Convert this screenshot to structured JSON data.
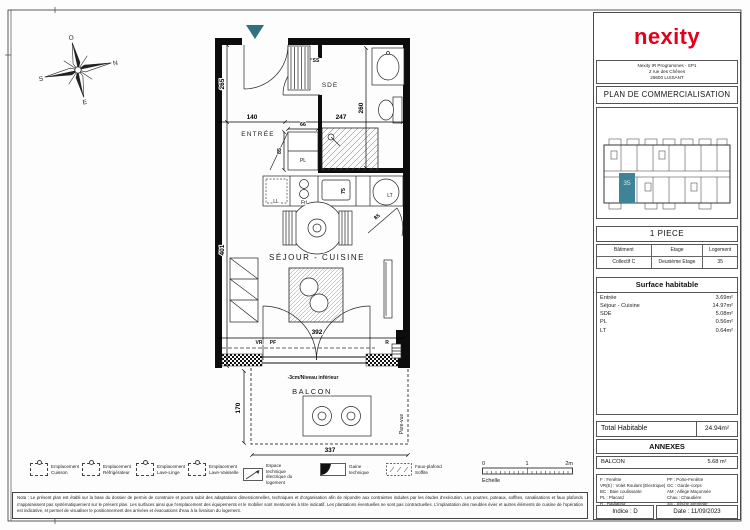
{
  "accent": {
    "teal": "#2d7183",
    "red": "#e2001a"
  },
  "brand": {
    "logo": "nexity"
  },
  "titleblock": {
    "address": [
      "Nexity IR Programmes - SP1",
      "2 rue des Chênes",
      "28600 LUISANT"
    ],
    "doc_title": "PLAN DE COMMERCIALISATION",
    "keyplan_unit": "35",
    "piece": "1 PIECE",
    "unit_headers": [
      "Bâtiment",
      "Etage",
      "Logement"
    ],
    "unit_values": [
      "Collectif C",
      "Deuxième Etage",
      "35"
    ],
    "surface_title": "Surface habitable",
    "surface_rows": [
      {
        "label": "Entrée",
        "value": "3.69m²"
      },
      {
        "label": "Séjour - Cuisine",
        "value": "14.97m²"
      },
      {
        "label": "SDE",
        "value": "5.08m²"
      },
      {
        "label": "PL",
        "value": "0.56m²"
      },
      {
        "label": "LT",
        "value": "0.64m²"
      }
    ],
    "total_label": "Total Habitable",
    "total_value": "24.94m²",
    "annexes_title": "ANNEXES",
    "annexe_label": "BALCON",
    "annexe_value": "5.68 m²",
    "abbr_left": [
      "F : Fenêtre",
      "VR(E) : Volet Roulant (Electrique)",
      "BC : Baie coulissante",
      "PL : Placard",
      "R : Radiateur"
    ],
    "abbr_right": [
      "PF : Porte-Fenêtre",
      "GC : Garde-corps",
      "AM : Allège Maçonnée",
      "Chau : Chaudière",
      "SS : Sèche Serviette"
    ],
    "indice": "Indice : D",
    "date": "Date : 11/09/2023"
  },
  "plan": {
    "rooms": {
      "entree": "ENTRÉE",
      "sde": "SDE",
      "sejour": "SÉJOUR - CUISINE",
      "balcon": "BALCON"
    },
    "labels": {
      "ss": "SS",
      "pl": "PL",
      "ll": "LL",
      "fri": "Fri",
      "lt": "LT",
      "vr": "VR",
      "pf": "PF",
      "r": "R",
      "level": "-3cm/Niveau inférieur",
      "pare_vue": "Pare-vue"
    },
    "dims": {
      "entree_h": "265",
      "top_left": "140",
      "top_right": "247",
      "sde_h": "260",
      "pl_w": "66",
      "pl_h": "85",
      "sink": "75",
      "door": "85",
      "sejour_h": "401",
      "sejour_w": "392",
      "balcon_h": "170",
      "balcon_w": "337"
    },
    "compass": {
      "n": "N",
      "s": "S",
      "e": "E",
      "o": "O"
    }
  },
  "legend": {
    "items": [
      "Emplacement Cuisson",
      "Emplacement Réfrigérateur",
      "Emplacement Lave-Linge",
      "Emplacement Lave-Vaisselle",
      "Espace technique électrique du logement",
      "Gaine technique",
      "Faux-plafond Soffite"
    ],
    "scale": {
      "t0": "0",
      "t1": "1",
      "t2": "2m",
      "label": "Echelle"
    }
  },
  "note": "Nota : Le présent plan est établi sur la base du dossier de permis de construire et pourra subir des adaptations dimensionnelles, techniques et d'organisation afin de répondre aux contraintes induites par les études d'exécution. Les poutres, poteaux, soffites, canalisations et faux plafonds n'apparaissent pas systématiquement sur le présent plan. Les surfaces ainsi que l'emplacement des équipements et le mobilier sont mentionnés à titre indicatif. Les plantations éventuelles ne sont pas contractuelles. L'implantation des meubles évier et autres éléments de cuisine de l'opération est indicative, et permet de visualiser le positionnement des arrivées et évacuations d'eau à la livraison du logement."
}
